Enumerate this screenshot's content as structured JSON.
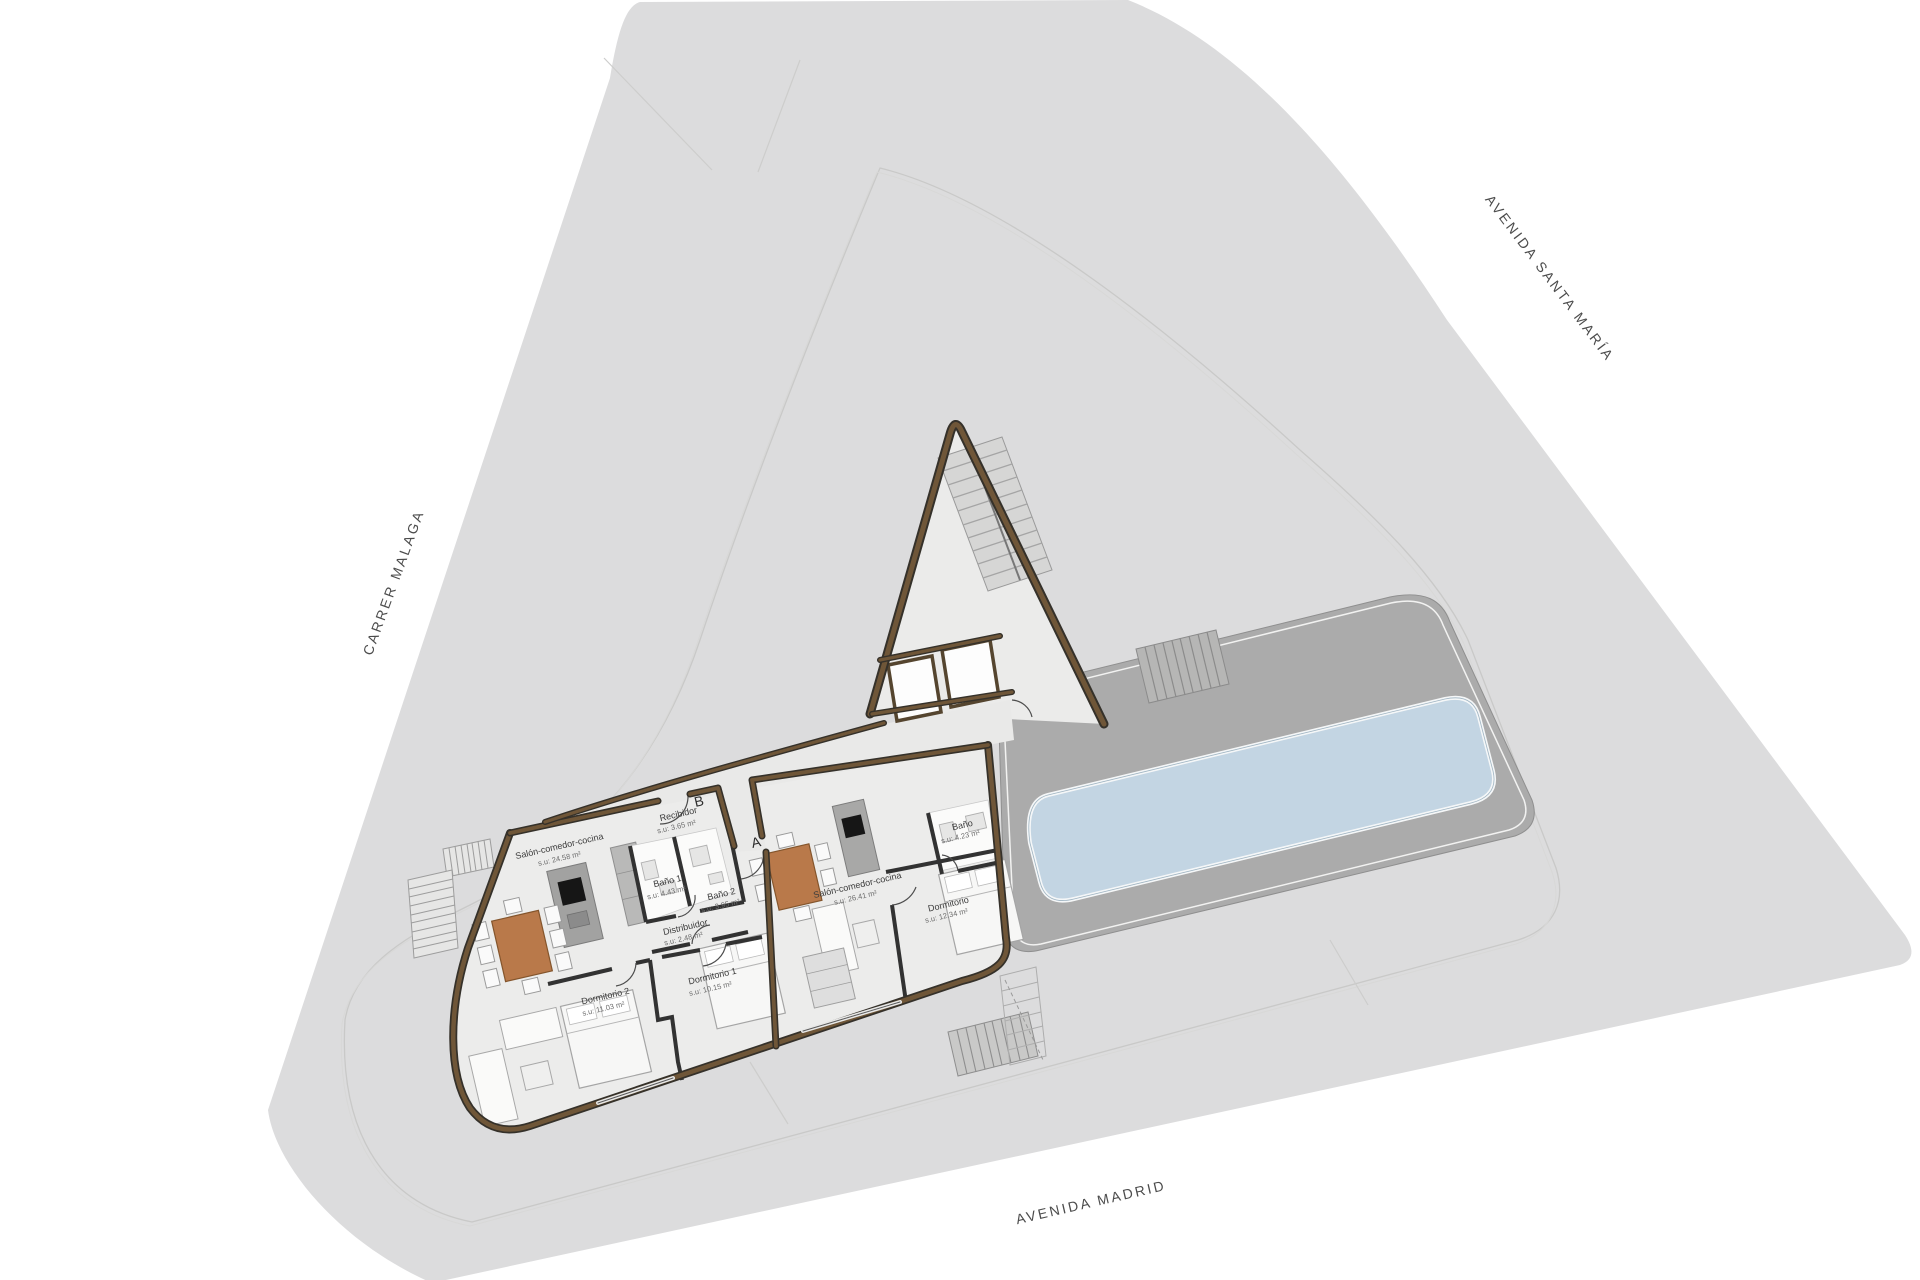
{
  "streets": {
    "left": "CARRER MALAGA",
    "right": "AVENIDA SANTA MARÍA",
    "bottom": "AVENIDA MADRID"
  },
  "units": {
    "b": {
      "marker": "B",
      "rooms": [
        {
          "name": "Salón-comedor-cocina",
          "area": "s.u: 24.58 m²"
        },
        {
          "name": "Recibidor",
          "area": "s.u: 3.65 m²"
        },
        {
          "name": "Baño 1",
          "area": "s.u: 4.43 m²"
        },
        {
          "name": "Baño 2",
          "area": "s.u: 3.95 m²"
        },
        {
          "name": "Distribuidor",
          "area": "s.u: 2.48 m²"
        },
        {
          "name": "Dormitorio 2",
          "area": "s.u: 11.03 m²"
        },
        {
          "name": "Dormitorio 1",
          "area": "s.u: 10.15 m²"
        }
      ]
    },
    "a": {
      "marker": "A",
      "rooms": [
        {
          "name": "Salón-comedor-cocina",
          "area": "s.u: 26.41 m²"
        },
        {
          "name": "Baño",
          "area": "s.u: 4.23 m²"
        },
        {
          "name": "Dormitorio",
          "area": "s.u: 12.34 m²"
        }
      ]
    }
  },
  "colors": {
    "site": "#dcdcdd",
    "deck": "#ababab",
    "pool": "#c3d5e3",
    "floor": "#ececeb",
    "wall": "#6f5638",
    "partition": "#323232",
    "furniture_wood": "#b9794a"
  }
}
